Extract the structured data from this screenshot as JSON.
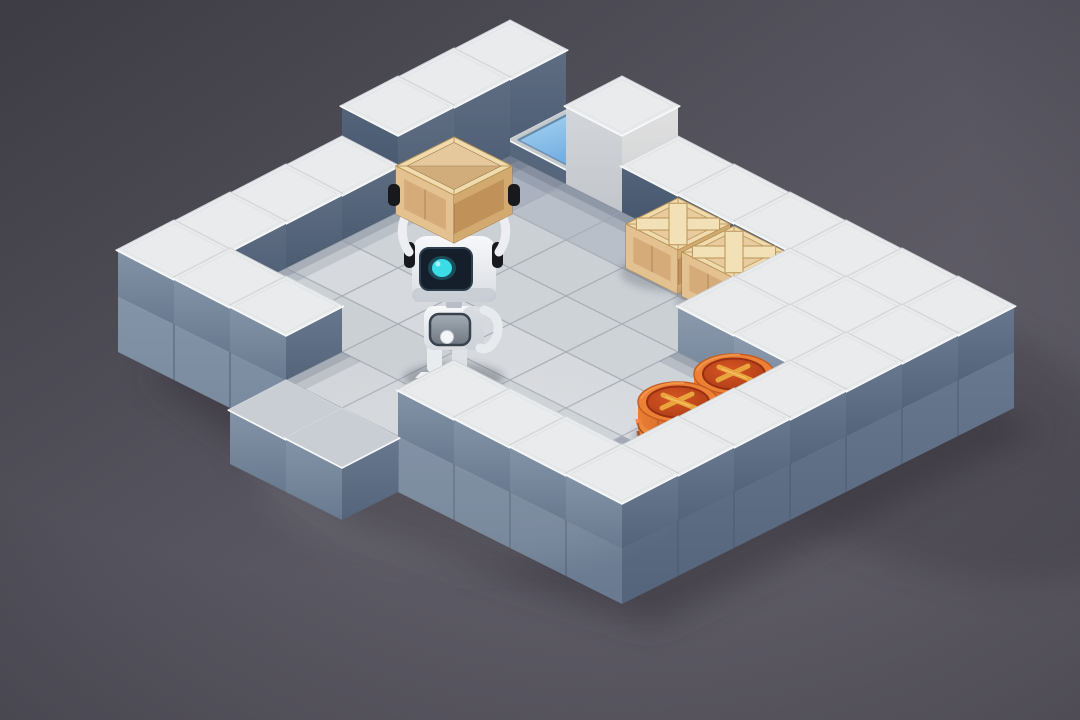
{
  "scene": {
    "name": "isometric-sokoban-room",
    "description": "voxel room with robot carrying a crate, two x-crates, two x-barrel targets, blue goal tile, entrance gap"
  },
  "level": {
    "cols": 9,
    "rows": 8,
    "tiles": [
      "TBXWWWWWW",
      "TFFFFFSSW",
      "TFFFFFSSW",
      "WFFFFFFFW",
      "WFFFFFFFW",
      "WFFFFFFfW",
      "WWWEEWWWW",
      "...ee...."
    ],
    "legend": {
      "T": "tall-wall-slate",
      "X": "tall-wall-white",
      "B": "goal-pedestal-blue-tile",
      "W": "wall-block",
      "S": "raised-slab-block",
      "F": "floor-tile",
      "f": "floor-tile-shadowed",
      "E": "entrance-floor-tile",
      "e": "outside-step-tile",
      ".": "ground"
    }
  },
  "entities": [
    {
      "name": "robot",
      "type": "robot-carrying-crate",
      "u": 4,
      "v": 5
    },
    {
      "name": "crate-1",
      "type": "wooden-crate-x",
      "u": 4,
      "v": 1
    },
    {
      "name": "crate-2",
      "type": "wooden-crate-x",
      "u": 5,
      "v": 1
    },
    {
      "name": "barrel-1",
      "type": "barrel-x-target",
      "u": 7,
      "v": 3
    },
    {
      "name": "barrel-2",
      "type": "barrel-x-target",
      "u": 7,
      "v": 4
    }
  ],
  "palette": {
    "background": {
      "top": "#3d3b43",
      "mid": "#55535d",
      "bottom": "#6d6a74",
      "shadow": "#34323b"
    },
    "floor": {
      "base": "#ced3d8",
      "alt": "#cbd0d5",
      "bright": "#d6d9dd",
      "shaded": "#b8bfc9",
      "corner": "#aab2bf",
      "leftShade": "#bcc3cc",
      "dark": "#9aa3b1",
      "entrance": "#d2d5d9",
      "outside": "#c9ced4",
      "seam": "#a9aeb6"
    },
    "caps": {
      "white": "#e9ebec",
      "pedestal": "#c6c9cc",
      "seam": "#d2d5d8",
      "bevel": "#f8f9fa",
      "inset": "#dfe1e3"
    },
    "faces": {
      "swOuterHi": "#8494a8",
      "swOuterLo": "#697a90",
      "seOuterHi": "#68798f",
      "seOuterLo": "#53647b",
      "swInnerHi": "#54647a",
      "swInnerLo": "#42526a",
      "seInnerHi": "#5e6d82",
      "seInnerLo": "#4c5c72",
      "swSlabHi": "#8c9bae",
      "swSlabLo": "#76869a",
      "whiteSwHi": "#d3d6da",
      "whiteSwLo": "#c2c6cc",
      "whiteSeHi": "#e0e0df",
      "whiteSeLo": "#cfd1d4",
      "pedestalSw": "#56667c",
      "pedestalSe": "#4a5a70",
      "baseSeam": "#4b586e"
    },
    "goal": {
      "blueHi": "#a8d4f4",
      "blueLo": "#6ca9dd",
      "edge": "#6e93b4",
      "innerShadow": "#55809f"
    },
    "crate": {
      "top": "#e8cc9e",
      "topFrame": "#f0dcae",
      "xPlank": "#f2e0b6",
      "plankEdge": "#b99357",
      "sw": "#d5ab79",
      "swFrame": "#e3c190",
      "se": "#c09158",
      "seFrame": "#d2a96f",
      "seam": "#9c7848",
      "panel": "#dcbd8e",
      "grainHi": "#e5c99c",
      "grainLo": "#d2ad7c"
    },
    "barrel": {
      "rim": "#ec8136",
      "rimEdge": "#c75c20",
      "top": "#c84a1e",
      "topDark": "#992f10",
      "x": "#eaa43c",
      "xHi": "#f7c065",
      "sideHi": "#e87f35",
      "sideLo": "#aa4a1c",
      "band": "#ef8a3c",
      "stave": "#a84818",
      "bottom": "#8f3d16"
    },
    "robot": {
      "body": "#f3f5f7",
      "bodyLo": "#d9dde2",
      "shade": "#c2c8d0",
      "screen": "#141f2b",
      "screenEdge": "#2e3d4d",
      "eye": "#3bdce6",
      "eyeGlow": "#35cfe2",
      "joint": "#17191d",
      "panelFrame": "#39424d",
      "panelHi": "#a4adb6",
      "panelLo": "#6f7881",
      "dot": "#f4f5f6",
      "shadow": "#2a3140"
    }
  }
}
